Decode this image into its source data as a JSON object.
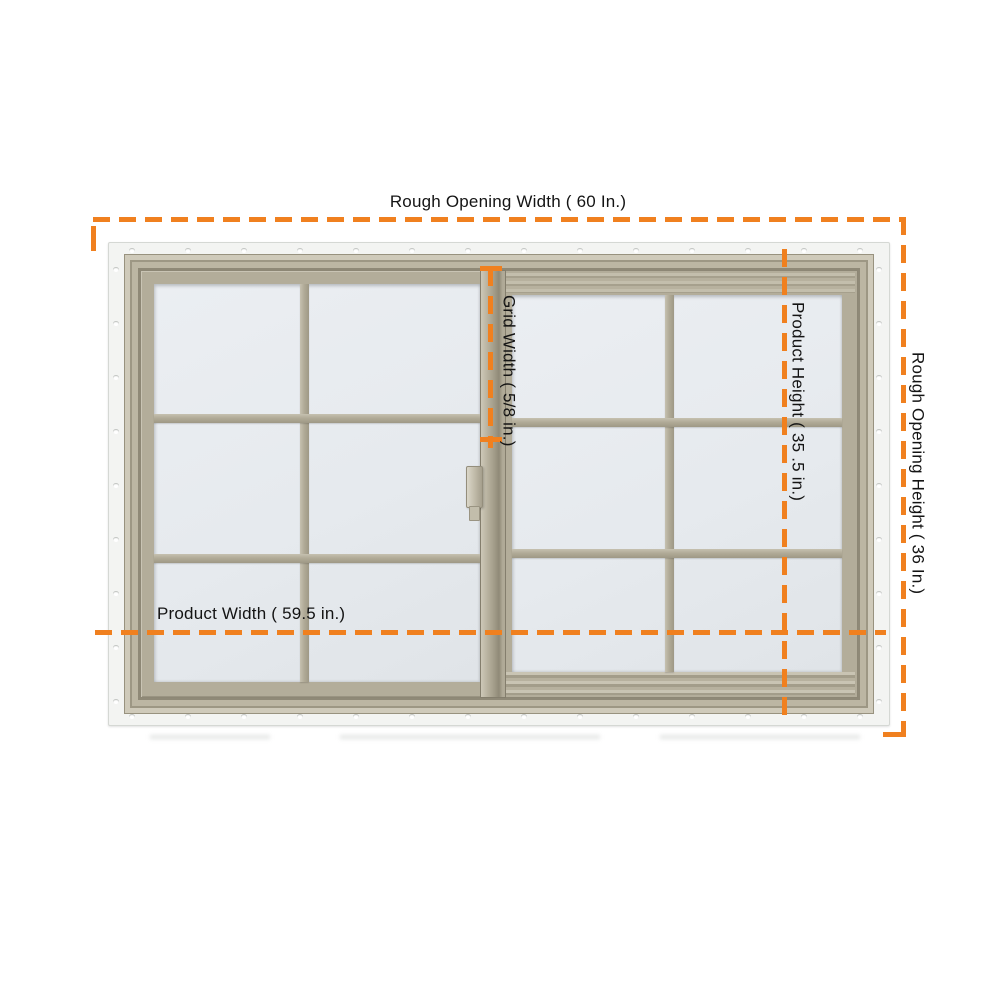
{
  "annotations": {
    "rough_opening_width": "Rough Opening Width ( 60 In.)",
    "rough_opening_height": "Rough Opening Height ( 36 In.)",
    "product_width": "Product Width ( 59.5 in.)",
    "product_height": "Product Height ( 35 .5 in.)",
    "grid_width": "Grid Width ( 5/8 in.)"
  },
  "colors": {
    "dimension_line": "#F0801F",
    "label_text": "#141414",
    "frame_tan": "#B3AD9A",
    "glass": "#E9EDF1",
    "flange_white": "#F3F4F2",
    "background": "#FFFFFF"
  },
  "window": {
    "type": "two-sash horizontal sliding window",
    "panes": [
      {
        "name": "left sash",
        "grid_cols": 2,
        "grid_rows": 3
      },
      {
        "name": "right sash",
        "grid_cols": 2,
        "grid_rows": 3
      }
    ]
  }
}
